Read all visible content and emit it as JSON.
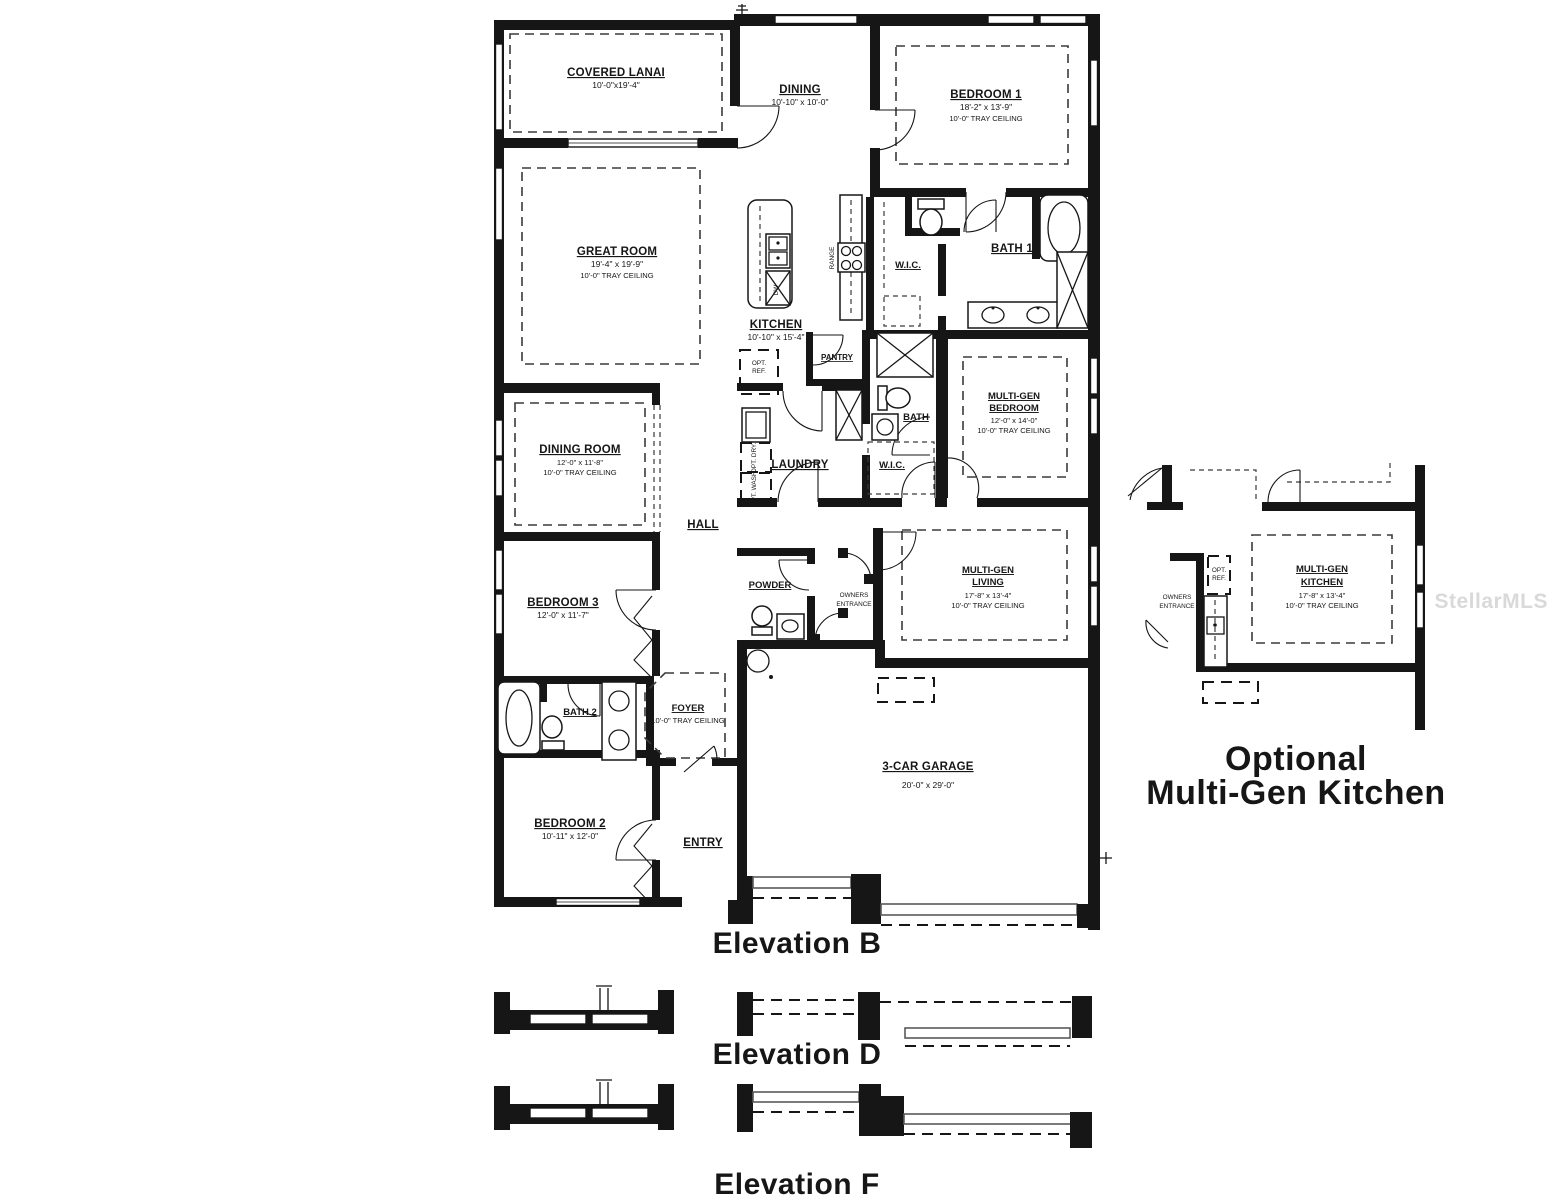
{
  "watermark": "StellarMLS",
  "rooms": {
    "covered_lanai": {
      "name": "COVERED LANAI",
      "dims": "10'-0\"x19'-4\""
    },
    "dining": {
      "name": "DINING",
      "dims": "10'-10\" x 10'-0\""
    },
    "bedroom_1": {
      "name": "BEDROOM 1",
      "dims": "18'-2\" x 13'-9\"",
      "ceiling": "10'-0\" TRAY CEILING"
    },
    "great_room": {
      "name": "GREAT ROOM",
      "dims": "19'-4\" x 19'-9\"",
      "ceiling": "10'-0\" TRAY CEILING"
    },
    "kitchen": {
      "name": "KITCHEN",
      "dims": "10'-10\" x 15'-4\""
    },
    "pantry": {
      "name": "PANTRY"
    },
    "opt_ref": {
      "line1": "OPT.",
      "line2": "REF."
    },
    "range": {
      "name": "RANGE"
    },
    "dishwasher": {
      "name": "DW"
    },
    "wic_bedroom1": {
      "name": "W.I.C."
    },
    "bath_1": {
      "name": "BATH 1"
    },
    "multigen_bedroom": {
      "line1": "MULTI-GEN",
      "line2": "BEDROOM",
      "dims": "12'-0\" x 14'-0\"",
      "ceiling": "10'-0\" TRAY CEILING"
    },
    "dining_room": {
      "name": "DINING ROOM",
      "dims": "12'-0\" x 11'-8\"",
      "ceiling": "10'-0\" TRAY CEILING"
    },
    "laundry": {
      "name": "LAUNDRY"
    },
    "opt_dry": {
      "name": "OPT. DRY."
    },
    "opt_wash": {
      "name": "OPT. WASH."
    },
    "bath_center": {
      "name": "BATH"
    },
    "wic_center": {
      "name": "W.I.C."
    },
    "hall": {
      "name": "HALL"
    },
    "bedroom_3": {
      "name": "BEDROOM 3",
      "dims": "12'-0\" x 11'-7\""
    },
    "powder": {
      "name": "POWDER"
    },
    "owners_entrance": {
      "line1": "OWNERS",
      "line2": "ENTRANCE"
    },
    "multigen_living": {
      "line1": "MULTI-GEN",
      "line2": "LIVING",
      "dims": "17'-8\" x 13'-4\"",
      "ceiling": "10'-0\" TRAY CEILING"
    },
    "bath_2": {
      "name": "BATH 2"
    },
    "foyer": {
      "name": "FOYER",
      "ceiling": "10'-0\" TRAY CEILING"
    },
    "bedroom_2": {
      "name": "BEDROOM 2",
      "dims": "10'-11\" x 12'-0\""
    },
    "entry": {
      "name": "ENTRY"
    },
    "garage": {
      "name": "3-CAR GARAGE",
      "dims": "20'-0\" x 29'-0\""
    }
  },
  "optional_kitchen": {
    "title_line1": "Optional",
    "title_line2": "Multi-Gen Kitchen",
    "room": {
      "line1": "MULTI-GEN",
      "line2": "KITCHEN",
      "dims": "17'-8\" x 13'-4\"",
      "ceiling": "10'-0\" TRAY CEILING"
    },
    "owners_entrance": {
      "line1": "OWNERS",
      "line2": "ENTRANCE"
    },
    "opt_ref": {
      "line1": "OPT.",
      "line2": "REF."
    }
  },
  "elevations": {
    "b": "Elevation B",
    "d": "Elevation D",
    "f": "Elevation F"
  }
}
